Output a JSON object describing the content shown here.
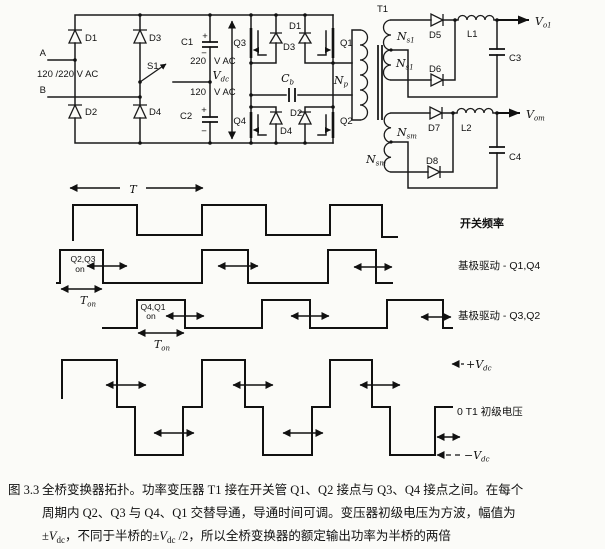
{
  "figure": {
    "colors": {
      "ink": "#111111",
      "paper": "#fbfbf8"
    },
    "circuit": {
      "input": {
        "terminal_a": "A",
        "terminal_b": "B",
        "mains": "120 /220 V AC",
        "d1": "D1",
        "d2": "D2",
        "d3": "D3",
        "d4": "D4",
        "s1": "S1",
        "c1": "C1",
        "c1_plus": "+",
        "c1_minus": "−",
        "c1_volt_num": "220",
        "c1_volt_unit": "V AC",
        "c2": "C2",
        "c2_plus": "+",
        "c2_minus": "−",
        "c2_volt_num": "120",
        "c2_volt_unit": "V AC",
        "vdc": {
          "base": "V",
          "sub": "dc"
        }
      },
      "bridge": {
        "q1": "Q1",
        "q2": "Q2",
        "q3": "Q3",
        "q4": "Q4",
        "d1": "D1",
        "d2": "D2",
        "d3": "D3",
        "d4": "D4",
        "cb": {
          "base": "C",
          "sub": "b"
        }
      },
      "transformer": {
        "t1": "T1",
        "np": {
          "base": "N",
          "sub": "p"
        },
        "ns1": {
          "base": "N",
          "sub": "s1"
        },
        "nsm": {
          "base": "N",
          "sub": "sm"
        }
      },
      "output1": {
        "d5": "D5",
        "d6": "D6",
        "l1": "L1",
        "c3": "C3",
        "vo1": {
          "base": "V",
          "sub": "o1"
        }
      },
      "output2": {
        "d7": "D7",
        "d8": "D8",
        "l2": "L2",
        "c4": "C4",
        "vom": {
          "base": "V",
          "sub": "om"
        }
      }
    },
    "waveforms": {
      "period": "T",
      "row1_label": "开关频率",
      "row2_label": "基极驱动 - Q1,Q4",
      "row3_label": "基极驱动 - Q3,Q2",
      "row2_pulse_line1": "Q2,Q3",
      "row2_pulse_line2": "on",
      "row3_pulse_line1": "Q4,Q1",
      "row3_pulse_line2": "on",
      "ton": {
        "base": "T",
        "sub": "on"
      },
      "plus_vdc": {
        "prefix": "+",
        "base": "V",
        "sub": "dc"
      },
      "zero_label": "0 T1 初级电压",
      "minus_vdc": {
        "prefix": "−",
        "base": "V",
        "sub": "dc"
      }
    },
    "caption": {
      "fig_label": "图 3.3",
      "line1": "全桥变换器拓扑。功率变压器 T1 接在开关管 Q1、Q2 接点与 Q3、Q4 接点之间。在每个",
      "line2": "周期内 Q2、Q3 与 Q4、Q1 交替导通，导通时间可调。变压器初级电压为方波，幅值为",
      "line3": {
        "s1": "±",
        "v1": "V",
        "sub1": "dc",
        "s2": "，不同于半桥的±",
        "v2": "V",
        "sub2": "dc",
        "s3": " /2，所以全桥变换器的额定输出功率为半桥的两倍"
      }
    }
  }
}
